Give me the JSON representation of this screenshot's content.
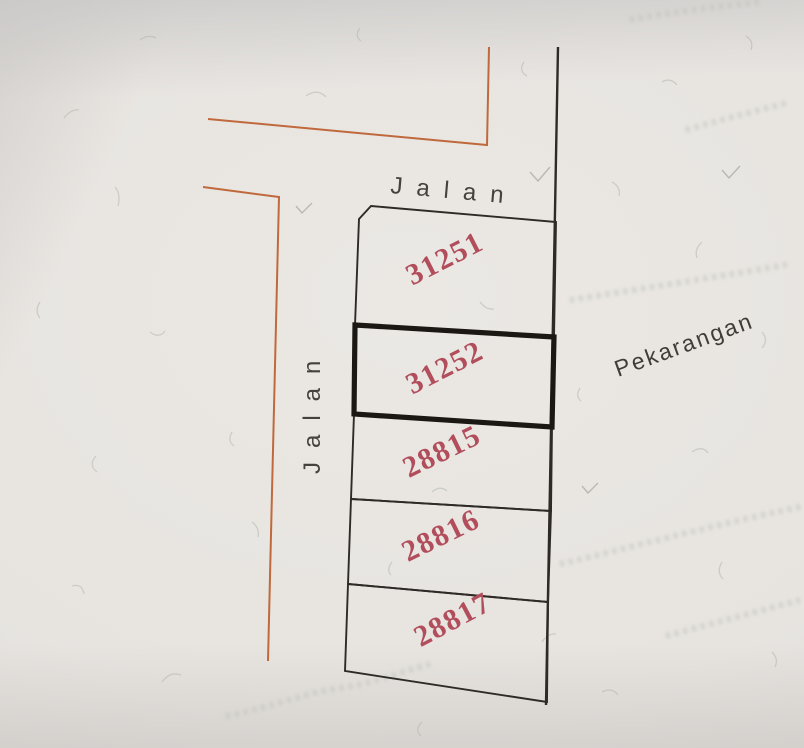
{
  "map": {
    "road_label_top": "Jalan",
    "road_label_left": "Jalan",
    "area_label": "Pekarangan",
    "parcels": [
      {
        "number": "31251",
        "highlighted": false
      },
      {
        "number": "31252",
        "highlighted": true
      },
      {
        "number": "28815",
        "highlighted": false
      },
      {
        "number": "28816",
        "highlighted": false
      },
      {
        "number": "28817",
        "highlighted": false
      }
    ],
    "colors": {
      "paper": "#e8e5e1",
      "road_line": "#c0693c",
      "boundary_line": "#2e2a26",
      "highlight_outline": "#1b1813",
      "parcel_number_text": "#b24e5c",
      "label_text": "#45413c"
    }
  }
}
